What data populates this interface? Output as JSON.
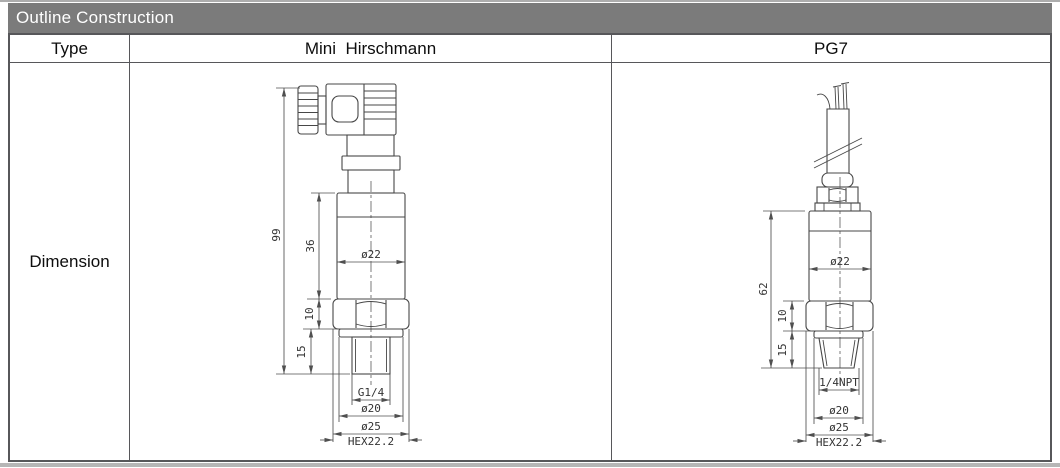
{
  "header": {
    "title": "Outline Construction"
  },
  "table": {
    "type_label": "Type",
    "col_mini": "Mini  Hirschmann",
    "col_pg7": "PG7",
    "row_label": "Dimension"
  },
  "colors": {
    "title_bar_bg": "#7b7b7b",
    "title_bar_text": "#ffffff",
    "table_border": "#57575a",
    "drawing_line": "#474747"
  },
  "drawings": {
    "mini_hirschmann": {
      "labels": {
        "overall_height": "99",
        "body_height": "36",
        "body_diameter": "ø22",
        "hex_height": "10",
        "thread_length": "15",
        "thread_size": "G1/4",
        "neck_diameter": "ø20",
        "flange_diameter": "ø25",
        "hex_size": "HEX22.2"
      }
    },
    "pg7": {
      "labels": {
        "overall_height": "62",
        "body_diameter": "ø22",
        "hex_height": "10",
        "thread_length": "15",
        "thread_size": "1/4NPT",
        "neck_diameter": "ø20",
        "flange_diameter": "ø25",
        "hex_size": "HEX22.2"
      }
    }
  }
}
